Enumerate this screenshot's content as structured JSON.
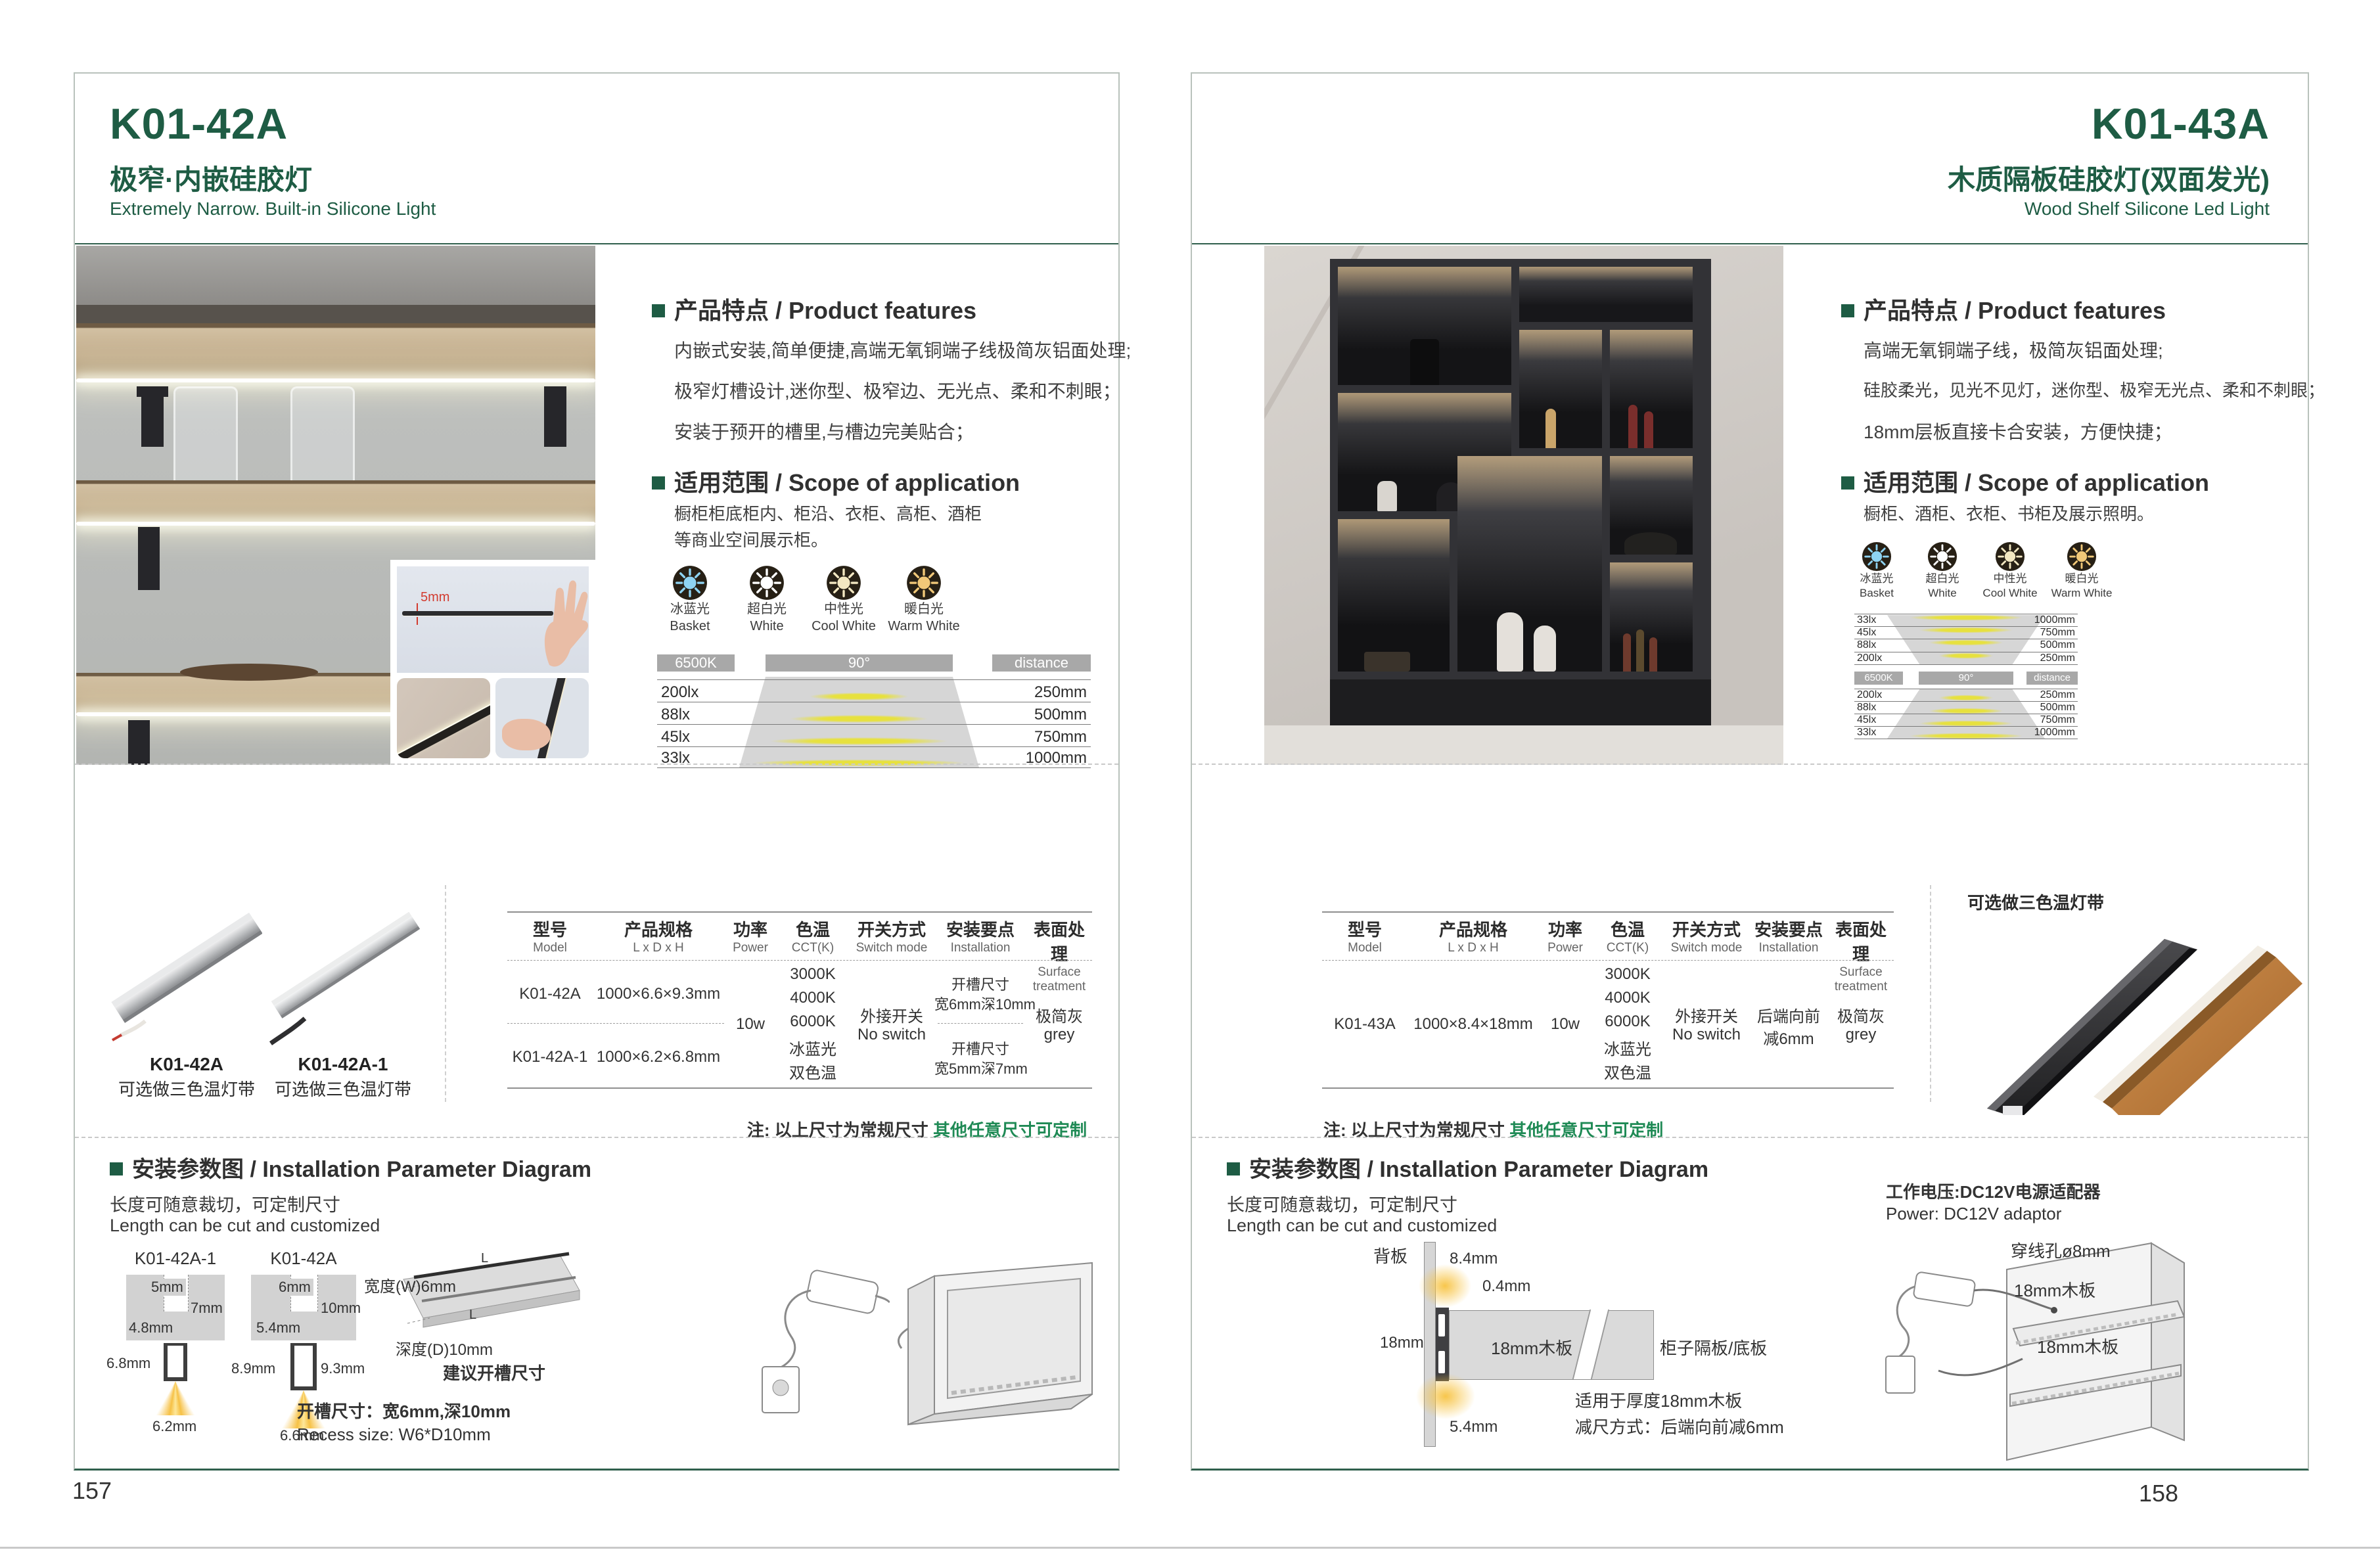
{
  "colors": {
    "accent_green": "#1e5c44",
    "note_green": "#1f8a55",
    "bar_gray": "#a8a8a8",
    "led_yellow": "#e7e13e"
  },
  "page_left": {
    "page_number": "157",
    "title": "K01-42A",
    "subtitle_cn": "极窄·内嵌硅胶灯",
    "subtitle_en": "Extremely Narrow. Built-in Silicone Light",
    "inset_dim": "5mm",
    "features_heading": "产品特点 / Product features",
    "features": [
      "内嵌式安装,简单便捷,高端无氧铜端子线极简灰铝面处理;",
      "极窄灯槽设计,迷你型、极窄边、无光点、柔和不刺眼；",
      "安装于预开的槽里,与槽边完美贴合；"
    ],
    "scope_heading": "适用范围 / Scope of application",
    "scope": [
      "橱柜柜底柜内、柜沿、衣柜、高柜、酒柜",
      "等商业空间展示柜。"
    ],
    "icons": [
      {
        "cn": "冰蓝光",
        "en": "Basket",
        "color": "#8ed3f2"
      },
      {
        "cn": "超白光",
        "en": "White",
        "color": "#ffffff"
      },
      {
        "cn": "中性光",
        "en": "Cool White",
        "color": "#f3e8c2"
      },
      {
        "cn": "暖白光",
        "en": "Warm White",
        "color": "#f1c878"
      }
    ],
    "lux": {
      "kelvin": "6500K",
      "angle": "90°",
      "distance": "distance",
      "rows": [
        {
          "lux": "200lx",
          "mm": "250mm"
        },
        {
          "lux": "88lx",
          "mm": "500mm"
        },
        {
          "lux": "45lx",
          "mm": "750mm"
        },
        {
          "lux": "33lx",
          "mm": "1000mm"
        }
      ]
    },
    "products": [
      {
        "model": "K01-42A",
        "note": "可选做三色温灯带"
      },
      {
        "model": "K01-42A-1",
        "note": "可选做三色温灯带"
      }
    ],
    "table": {
      "headers": [
        {
          "cn": "型号",
          "en": "Model"
        },
        {
          "cn": "产品规格",
          "en": "L x D x H"
        },
        {
          "cn": "功率",
          "en": "Power"
        },
        {
          "cn": "色温",
          "en": "CCT(K)"
        },
        {
          "cn": "开关方式",
          "en": "Switch mode"
        },
        {
          "cn": "安装要点",
          "en": "Installation"
        },
        {
          "cn": "表面处理",
          "en": "Surface treatment"
        }
      ],
      "rows": [
        {
          "model": "K01-42A",
          "size": "1000×6.6×9.3mm",
          "install1": "开槽尺寸",
          "install2": "宽6mm深10mm"
        },
        {
          "model": "K01-42A-1",
          "size": "1000×6.2×6.8mm",
          "install1": "开槽尺寸",
          "install2": "宽5mm深7mm"
        }
      ],
      "power": "10w",
      "cct": [
        "3000K",
        "4000K",
        "6000K",
        "冰蓝光",
        "双色温"
      ],
      "switch1": "外接开关",
      "switch2": "No switch",
      "surface1": "极简灰",
      "surface2": "grey"
    },
    "note_prefix": "注: 以上尺寸为常规尺寸 ",
    "note_highlight": "其他任意尺寸可定制",
    "install": {
      "heading": "安装参数图 / Installation Parameter Diagram",
      "cut_cn": "长度可随意裁切，可定制尺寸",
      "cut_en": "Length can be cut and customized",
      "d1": {
        "label": "K01-42A-1",
        "top": "5mm",
        "depth": "7mm",
        "slot": "4.8mm",
        "h": "6.8mm",
        "bottom": "6.2mm"
      },
      "d2": {
        "label": "K01-42A",
        "top": "6mm",
        "depth": "10mm",
        "slot": "5.4mm",
        "h_left": "8.9mm",
        "h_right": "9.3mm",
        "bottom": "6.6mm"
      },
      "board": {
        "w": "宽度(W)6mm",
        "d": "深度(D)10mm",
        "suggest": "建议开槽尺寸",
        "l1": "L",
        "l2": "L"
      },
      "recess_cn": "开槽尺寸：宽6mm,深10mm",
      "recess_en": "Recess size: W6*D10mm"
    }
  },
  "page_right": {
    "page_number": "158",
    "title": "K01-43A",
    "subtitle_cn": "木质隔板硅胶灯(双面发光)",
    "subtitle_en": "Wood Shelf Silicone Led Light",
    "features_heading": "产品特点 / Product features",
    "features": [
      "高端无氧铜端子线，极简灰铝面处理;",
      "硅胶柔光，见光不见灯，迷你型、极窄无光点、柔和不刺眼；",
      "18mm层板直接卡合安装，方便快捷；"
    ],
    "scope_heading": "适用范围 / Scope of application",
    "scope": [
      "橱柜、酒柜、衣柜、书柜及展示照明。"
    ],
    "icons": [
      {
        "cn": "冰蓝光",
        "en": "Basket",
        "color": "#8ed3f2"
      },
      {
        "cn": "超白光",
        "en": "White",
        "color": "#ffffff"
      },
      {
        "cn": "中性光",
        "en": "Cool White",
        "color": "#f3e8c2"
      },
      {
        "cn": "暖白光",
        "en": "Warm White",
        "color": "#f1c878"
      }
    ],
    "lux": {
      "kelvin": "6500K",
      "angle": "90°",
      "distance": "distance",
      "top_rows": [
        {
          "lux": "33lx",
          "mm": "1000mm"
        },
        {
          "lux": "45lx",
          "mm": "750mm"
        },
        {
          "lux": "88lx",
          "mm": "500mm"
        },
        {
          "lux": "200lx",
          "mm": "250mm"
        }
      ],
      "bottom_rows": [
        {
          "lux": "200lx",
          "mm": "250mm"
        },
        {
          "lux": "88lx",
          "mm": "500mm"
        },
        {
          "lux": "45lx",
          "mm": "750mm"
        },
        {
          "lux": "33lx",
          "mm": "1000mm"
        }
      ]
    },
    "product_note": "可选做三色温灯带",
    "table": {
      "headers": [
        {
          "cn": "型号",
          "en": "Model"
        },
        {
          "cn": "产品规格",
          "en": "L x D x H"
        },
        {
          "cn": "功率",
          "en": "Power"
        },
        {
          "cn": "色温",
          "en": "CCT(K)"
        },
        {
          "cn": "开关方式",
          "en": "Switch mode"
        },
        {
          "cn": "安装要点",
          "en": "Installation"
        },
        {
          "cn": "表面处理",
          "en": "Surface treatment"
        }
      ],
      "row": {
        "model": "K01-43A",
        "size": "1000×8.4×18mm"
      },
      "power": "10w",
      "cct": [
        "3000K",
        "4000K",
        "6000K",
        "冰蓝光",
        "双色温"
      ],
      "switch1": "外接开关",
      "switch2": "No switch",
      "install1": "后端向前",
      "install2": "减6mm",
      "surface1": "极简灰",
      "surface2": "grey"
    },
    "note_prefix": "注: 以上尺寸为常规尺寸 ",
    "note_highlight": "其他任意尺寸可定制",
    "install": {
      "heading": "安装参数图 / Installation Parameter Diagram",
      "cut_cn": "长度可随意裁切，可定制尺寸",
      "cut_en": "Length can be cut and customized",
      "backboard": "背板",
      "d84": "8.4mm",
      "d04": "0.4mm",
      "d18": "18mm",
      "board_label": "18mm木板",
      "shelf_label": "柜子隔板/底板",
      "d54": "5.4mm",
      "fit1": "适用于厚度18mm木板",
      "fit2": "减尺方式：后端向前减6mm",
      "power_cn": "工作电压:DC12V电源适配器",
      "power_en": "Power: DC12V adaptor",
      "hole": "穿线孔ø8mm",
      "wood1": "18mm木板",
      "wood2": "18mm木板"
    }
  }
}
